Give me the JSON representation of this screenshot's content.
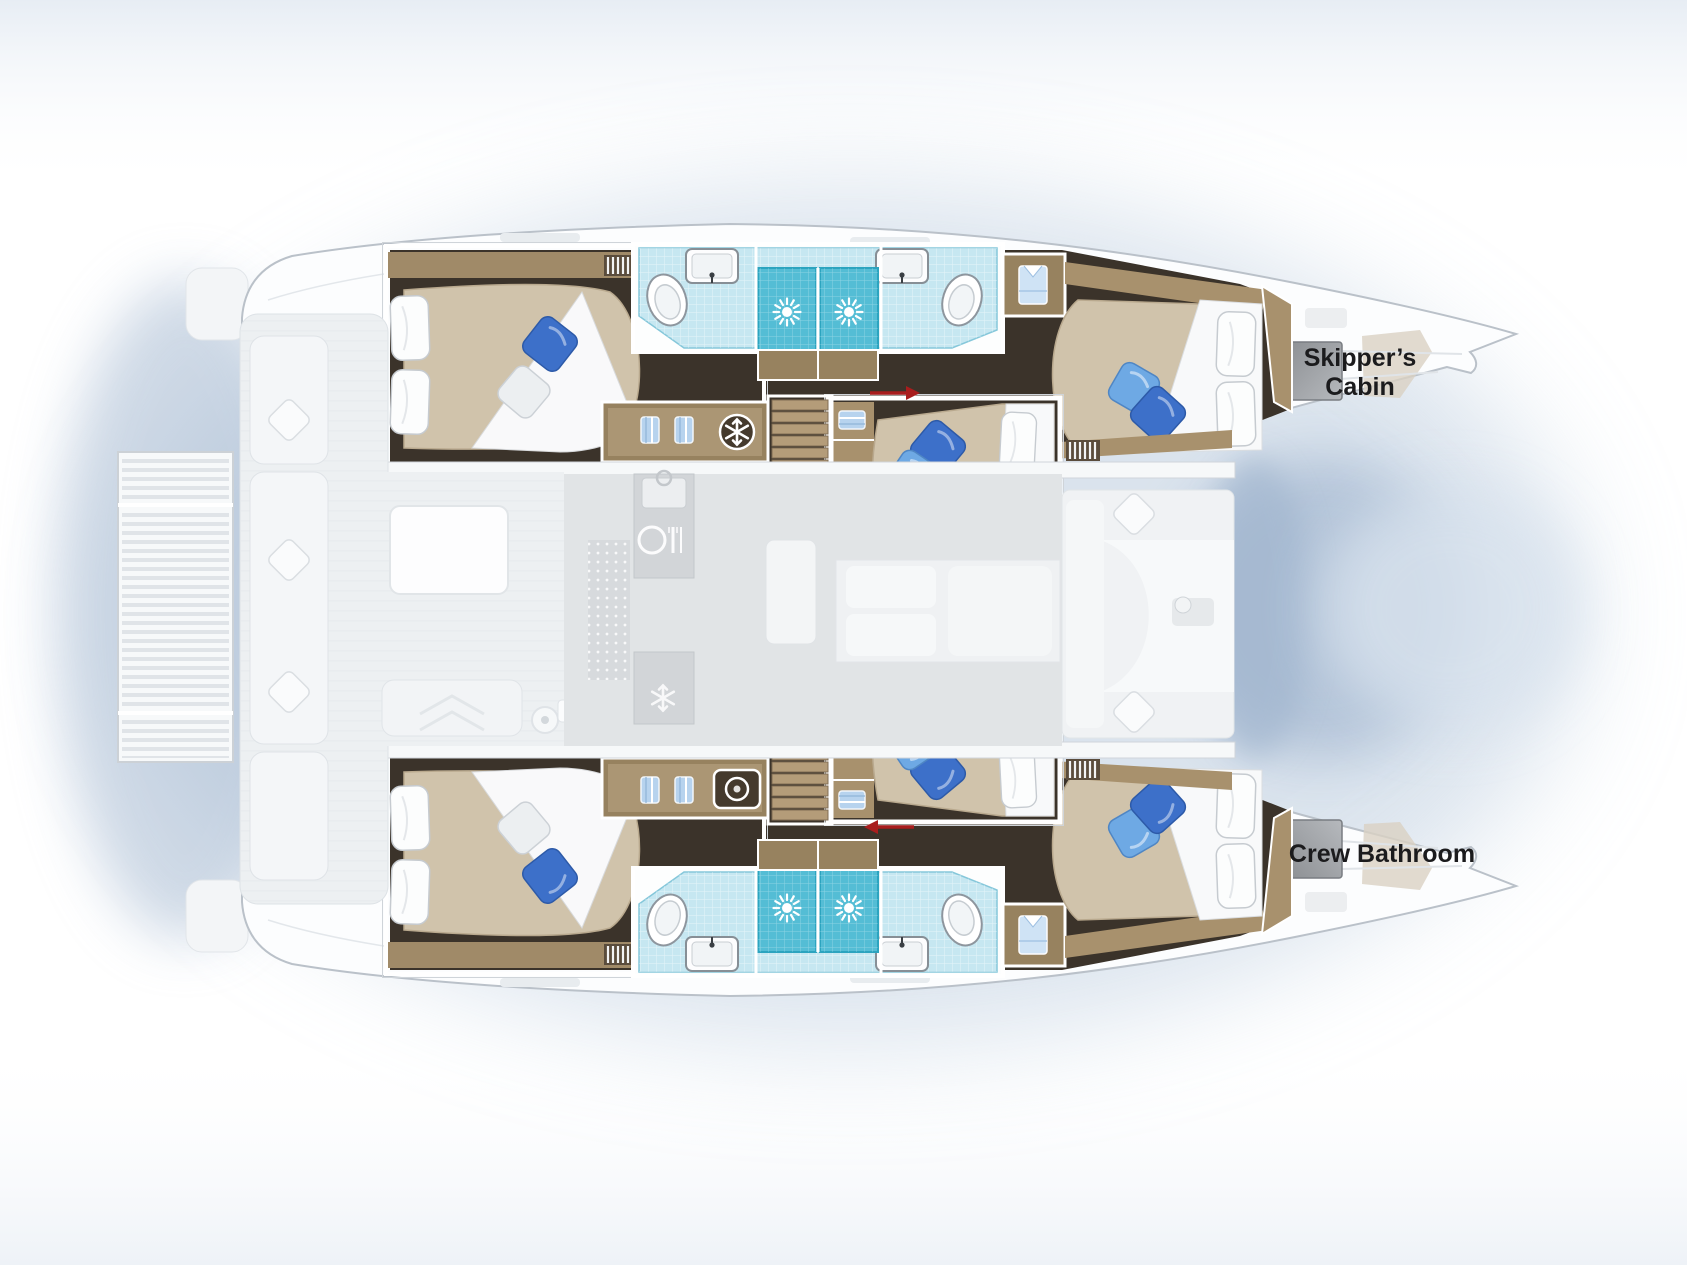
{
  "page": {
    "background_color": "#ffffff",
    "description": "Top-down floor plan of a sailing catamaran, bow facing right"
  },
  "labels": {
    "skippers_cabin_line1": "Skipper’s",
    "skippers_cabin_line2": "Cabin",
    "crew_bathroom": "Crew Bathroom"
  },
  "plan": {
    "vessel_type": "sailing catamaran",
    "view": "top-down deck plan",
    "hulls": [
      {
        "side": "port",
        "position": "top",
        "rooms": [
          "aft double cabin",
          "aft bathroom with shower",
          "forward bathroom with shower",
          "forward double cabin",
          "skipper's cabin in bow"
        ]
      },
      {
        "side": "starboard",
        "position": "bottom",
        "rooms": [
          "aft double cabin",
          "aft bathroom with shower",
          "forward bathroom with shower",
          "forward double cabin",
          "crew bathroom in bow"
        ]
      }
    ],
    "center_sections": [
      "stern platform",
      "aft cockpit with table",
      "saloon with galley",
      "two center double cabins with convertible berths",
      "forward cockpit seating",
      "bow trampoline"
    ],
    "icons": [
      {
        "name": "snowflake-icon",
        "meaning": "fridge-freezer"
      },
      {
        "name": "washer-icon",
        "meaning": "washing machine"
      },
      {
        "name": "shower-head-icon",
        "meaning": "shower stall"
      },
      {
        "name": "cutlery-icon",
        "meaning": "galley"
      },
      {
        "name": "towel-shelf-icon",
        "meaning": "storage shelves"
      },
      {
        "name": "red-arrow-icon",
        "meaning": "sliding / convertible berth"
      }
    ]
  },
  "colors": {
    "hull_white": "#fcfdfe",
    "shadow_blue": "#bccbdd",
    "floor_dark_wood": "#3b332a",
    "trim_wood": "#a8916d",
    "mattress_beige": "#d0c3ab",
    "tile_light_blue": "#c6e7f1",
    "shower_teal": "#54bdd5",
    "pillow_blue_dark": "#3d70c9",
    "pillow_blue_light": "#6ea9e4",
    "arrow_red": "#a81d1d",
    "label_text": "#1b1b1d",
    "hatch_gray": "#9b9ea2"
  }
}
